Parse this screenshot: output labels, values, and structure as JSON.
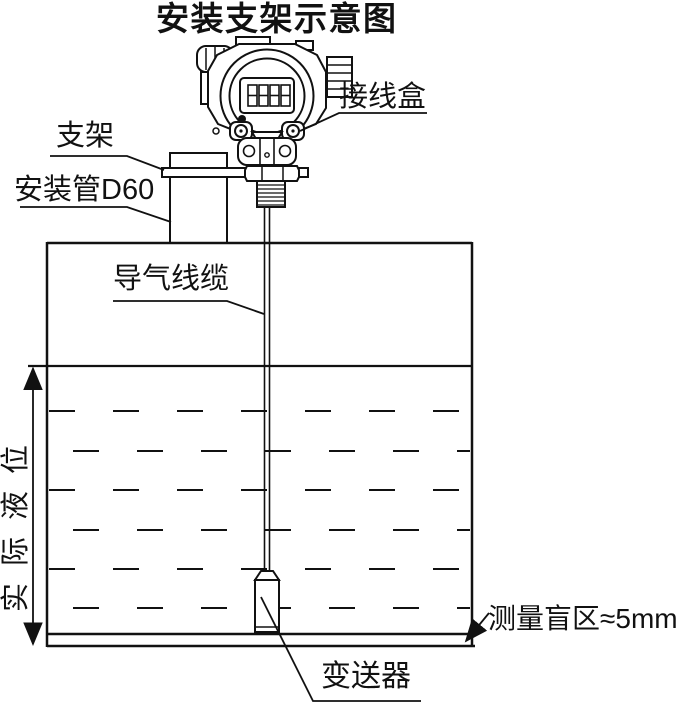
{
  "title": "安装支架示意图",
  "labels": {
    "junction_box": "接线盒",
    "bracket": "支架",
    "mounting_pipe": "安装管D60",
    "vent_cable": "导气线缆",
    "actual_level": "实际液位",
    "transmitter": "变送器",
    "blind_zone": "测量盲区≈5mm"
  },
  "colors": {
    "line": "#111111",
    "background": "#ffffff",
    "text": "#111111"
  }
}
